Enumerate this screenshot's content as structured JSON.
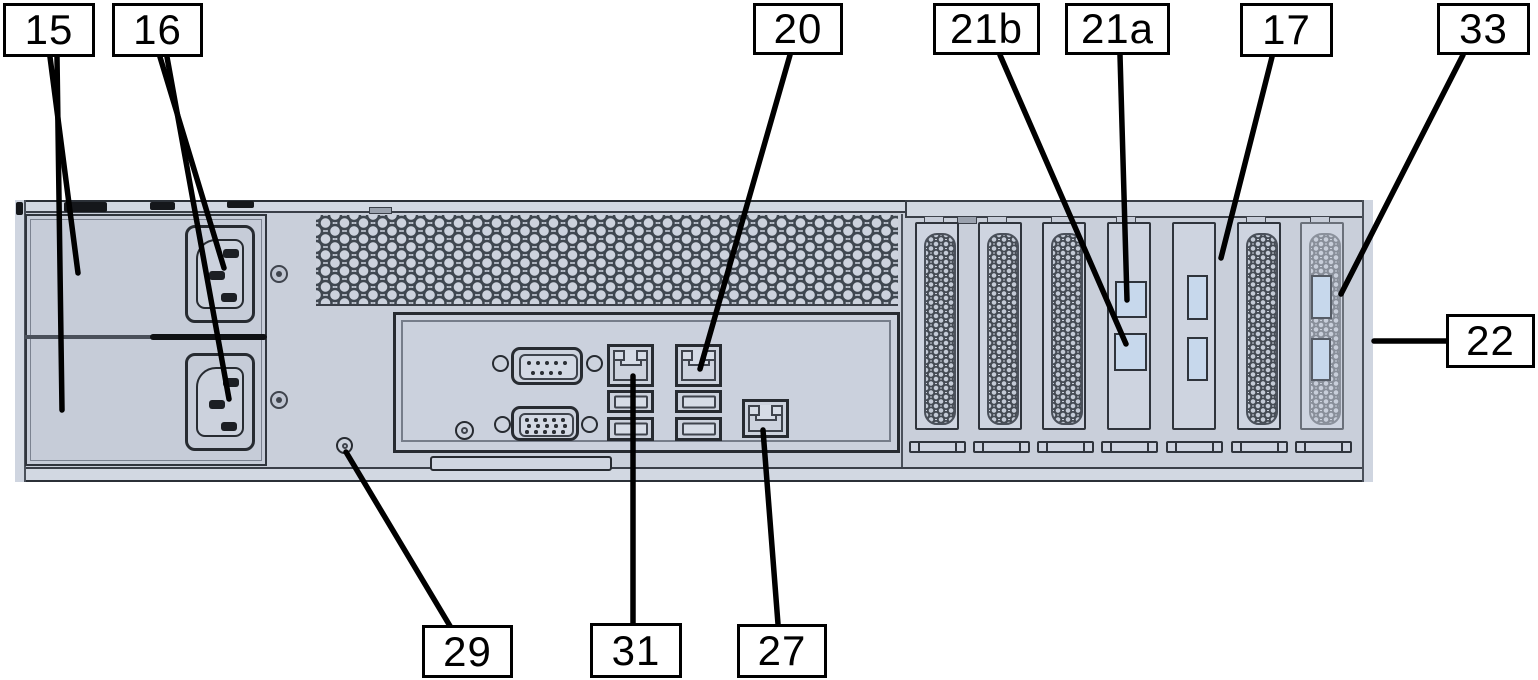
{
  "figure": {
    "description": "Rear view diagram of rack server chassis with numbered callouts"
  },
  "colors": {
    "chassis": "#c9cfda",
    "bay": "#c6ccd8",
    "port_blue": "#c7d8ec",
    "outline": "#272b31",
    "leader": "#000000"
  },
  "callouts": [
    {
      "label": "15",
      "box": {
        "x": 3,
        "y": 3,
        "w": 92,
        "h": 54
      },
      "lines": [
        [
          50,
          57,
          78,
          273
        ],
        [
          57,
          57,
          62,
          410
        ]
      ]
    },
    {
      "label": "16",
      "box": {
        "x": 112,
        "y": 3,
        "w": 91,
        "h": 54
      },
      "lines": [
        [
          160,
          57,
          224,
          268
        ],
        [
          167,
          57,
          229,
          399
        ]
      ]
    },
    {
      "label": "20",
      "box": {
        "x": 753,
        "y": 3,
        "w": 90,
        "h": 52
      },
      "lines": [
        [
          790,
          55,
          700,
          369
        ]
      ]
    },
    {
      "label": "21b",
      "box": {
        "x": 933,
        "y": 3,
        "w": 107,
        "h": 52
      },
      "lines": [
        [
          1000,
          55,
          1126,
          344
        ]
      ]
    },
    {
      "label": "21a",
      "box": {
        "x": 1065,
        "y": 3,
        "w": 105,
        "h": 52
      },
      "lines": [
        [
          1120,
          55,
          1127,
          300
        ]
      ]
    },
    {
      "label": "17",
      "box": {
        "x": 1240,
        "y": 3,
        "w": 93,
        "h": 54
      },
      "lines": [
        [
          1272,
          57,
          1221,
          258
        ]
      ]
    },
    {
      "label": "33",
      "box": {
        "x": 1437,
        "y": 3,
        "w": 93,
        "h": 52
      },
      "lines": [
        [
          1463,
          55,
          1341,
          294
        ]
      ]
    },
    {
      "label": "22",
      "box": {
        "x": 1446,
        "y": 314,
        "w": 89,
        "h": 54
      },
      "lines": [
        [
          1446,
          341,
          1374,
          341
        ]
      ]
    },
    {
      "label": "29",
      "box": {
        "x": 422,
        "y": 625,
        "w": 91,
        "h": 53
      },
      "lines": [
        [
          450,
          626,
          346,
          452
        ]
      ]
    },
    {
      "label": "31",
      "box": {
        "x": 590,
        "y": 623,
        "w": 92,
        "h": 55
      },
      "lines": [
        [
          633,
          624,
          633,
          376
        ]
      ]
    },
    {
      "label": "27",
      "box": {
        "x": 737,
        "y": 624,
        "w": 90,
        "h": 54
      },
      "lines": [
        [
          778,
          624,
          763,
          430
        ]
      ]
    }
  ]
}
